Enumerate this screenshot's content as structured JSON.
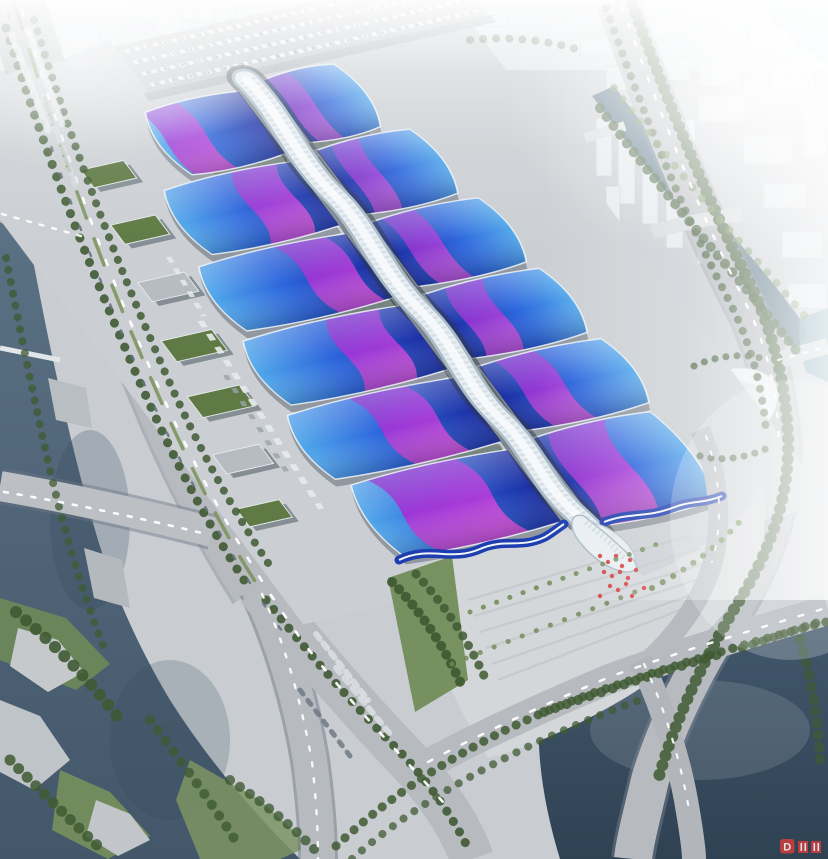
{
  "meta": {
    "alt": "Aerial architectural rendering of a large exhibition and convention center: parallel rows of blue wave-form exhibition halls with magenta ribbon roof graphics, crossed by a white serpentine central concourse ending in a flared entrance canopy at a palm-lined plaza, surrounded by boulevards, canals, rivers, parking lots and a hazy white cityscape."
  },
  "watermark": {
    "letter": "D"
  },
  "palette": {
    "ground": "#c9cdd2",
    "apron": "#cbcfd3",
    "road": "#b7bbc0",
    "road_shadow": "#858d97",
    "hall_deep": "#1b2ea2",
    "hall_blue": "#2b64dc",
    "hall_light": "#4fa6ea",
    "ribbon_purple": "#6a1ec6",
    "ribbon_violet": "#a032d6",
    "ribbon_magenta": "#d44fda",
    "spine_white": "#e9eef2",
    "spine_shade": "#a9bcc8",
    "gutter_dark": "#2c3744",
    "river": "#54697c",
    "canal": "#527083",
    "pond": "#3a4f63",
    "bright_water": "#84bccd",
    "tree_dark": "#3f5a33",
    "tree_light": "#6d8a52",
    "grass": "#567639",
    "plaza": "#d4d7da",
    "haze": "#ffffff",
    "accent_red": "#d23c3c"
  },
  "scene": {
    "halls": [
      {
        "s": "L",
        "o": -120,
        "i": -14,
        "t": 0,
        "b": 78,
        "rc": -92,
        "rw": 40,
        "sw": 16,
        "ro": 0.92
      },
      {
        "s": "R",
        "o": 96,
        "i": 14,
        "t": -6,
        "b": 72,
        "rc": 32,
        "rw": 24,
        "sw": 10,
        "ro": 0.7
      },
      {
        "s": "L",
        "o": -155,
        "i": -14,
        "t": 88,
        "b": 168,
        "rc": -58,
        "rw": 46,
        "sw": -20,
        "ro": 0.9
      },
      {
        "s": "R",
        "o": 120,
        "i": 14,
        "t": 82,
        "b": 162,
        "rc": 42,
        "rw": 28,
        "sw": -12,
        "ro": 0.75
      },
      {
        "s": "L",
        "o": -175,
        "i": -14,
        "t": 178,
        "b": 258,
        "rc": -54,
        "rw": 50,
        "sw": 22,
        "ro": 0.9
      },
      {
        "s": "R",
        "o": 135,
        "i": 14,
        "t": 172,
        "b": 252,
        "rc": 48,
        "rw": 34,
        "sw": 14,
        "ro": 0.8
      },
      {
        "s": "L",
        "o": -185,
        "i": -14,
        "t": 268,
        "b": 348,
        "rc": -68,
        "rw": 54,
        "sw": -22,
        "ro": 0.9
      },
      {
        "s": "R",
        "o": 142,
        "i": 14,
        "t": 262,
        "b": 342,
        "rc": 52,
        "rw": 38,
        "sw": -16,
        "ro": 0.82
      },
      {
        "s": "L",
        "o": -195,
        "i": -14,
        "t": 358,
        "b": 438,
        "rc": -84,
        "rw": 58,
        "sw": 24,
        "ro": 0.92
      },
      {
        "s": "R",
        "o": 150,
        "i": 14,
        "t": 352,
        "b": 432,
        "rc": 58,
        "rw": 42,
        "sw": 18,
        "ro": 0.85
      },
      {
        "s": "L",
        "o": -185,
        "i": -14,
        "t": 448,
        "b": 538,
        "rc": -104,
        "rw": 92,
        "sw": 28,
        "ro": 0.95
      },
      {
        "s": "R",
        "o": 145,
        "i": 14,
        "t": 442,
        "b": 552,
        "rc": 54,
        "rw": 58,
        "sw": -22,
        "ro": 0.9
      }
    ],
    "green_strips": [
      {
        "x": -90,
        "y": 62,
        "w": 72,
        "h": 26
      },
      {
        "x": 18,
        "y": 62,
        "w": 54,
        "h": 26
      },
      {
        "x": -100,
        "y": 248,
        "w": 82,
        "h": 26
      },
      {
        "x": -84,
        "y": 439,
        "w": 64,
        "h": 22
      }
    ],
    "service_buildings": [
      {
        "u": -206,
        "v": 46,
        "w": 44,
        "h": 22,
        "g": 1
      },
      {
        "u": -216,
        "v": 112,
        "w": 46,
        "h": 24,
        "g": 1
      },
      {
        "u": -230,
        "v": 180,
        "w": 48,
        "h": 24,
        "g": 0
      },
      {
        "u": -248,
        "v": 248,
        "w": 52,
        "h": 26,
        "g": 1
      },
      {
        "u": -262,
        "v": 314,
        "w": 54,
        "h": 26,
        "g": 1
      },
      {
        "u": -278,
        "v": 382,
        "w": 48,
        "h": 24,
        "g": 0
      },
      {
        "u": -293,
        "v": 446,
        "w": 44,
        "h": 22,
        "g": 1
      }
    ],
    "city_top_blocks": [
      [
        6,
        6,
        38,
        16
      ],
      [
        50,
        10,
        34,
        14
      ],
      [
        90,
        2,
        42,
        18
      ],
      [
        138,
        8,
        38,
        14
      ],
      [
        182,
        0,
        48,
        20
      ],
      [
        236,
        6,
        42,
        16
      ],
      [
        284,
        10,
        38,
        14
      ],
      [
        328,
        2,
        40,
        18
      ],
      [
        374,
        8,
        42,
        16
      ],
      [
        422,
        4,
        38,
        18
      ],
      [
        464,
        10,
        44,
        16
      ],
      [
        240,
        30,
        60,
        22
      ],
      [
        148,
        28,
        44,
        18
      ],
      [
        60,
        32,
        40,
        16
      ],
      [
        8,
        34,
        36,
        14
      ],
      [
        312,
        34,
        52,
        18
      ],
      [
        380,
        32,
        46,
        16
      ],
      [
        434,
        34,
        40,
        14
      ]
    ],
    "city_domes": [
      [
        168,
        24,
        13
      ],
      [
        206,
        15,
        9
      ],
      [
        232,
        27,
        7
      ]
    ],
    "city_right_blocks": [
      [
        580,
        36,
        46,
        20
      ],
      [
        632,
        18,
        52,
        22
      ],
      [
        690,
        8,
        56,
        24
      ],
      [
        748,
        26,
        50,
        22
      ],
      [
        800,
        16,
        26,
        36
      ],
      [
        606,
        66,
        34,
        24
      ],
      [
        648,
        58,
        42,
        22
      ],
      [
        698,
        96,
        46,
        26
      ],
      [
        744,
        136,
        48,
        28
      ],
      [
        764,
        184,
        42,
        24
      ],
      [
        782,
        232,
        40,
        26
      ],
      [
        700,
        64,
        40,
        22
      ],
      [
        770,
        64,
        44,
        24
      ],
      [
        804,
        110,
        22,
        48
      ],
      [
        788,
        284,
        38,
        24
      ]
    ],
    "city_towers": [
      [
        596,
        118,
        16,
        58
      ],
      [
        618,
        138,
        17,
        66
      ],
      [
        642,
        148,
        16,
        76
      ],
      [
        666,
        168,
        17,
        80
      ],
      [
        697,
        198,
        15,
        66
      ],
      [
        638,
        92,
        13,
        48
      ],
      [
        718,
        228,
        15,
        58
      ],
      [
        742,
        258,
        13,
        50
      ],
      [
        606,
        186,
        14,
        48
      ],
      [
        682,
        120,
        13,
        44
      ]
    ],
    "treelines": [
      {
        "d": "M 6,28 C 36,124 78,240 126,350 C 162,436 200,512 244,580",
        "w": 9,
        "g": 13,
        "o": 0.9,
        "l": 0
      },
      {
        "d": "M 34,20 C 64,118 104,232 152,342 C 188,428 226,500 270,566",
        "w": 8,
        "g": 12,
        "o": 0.85,
        "l": 0
      },
      {
        "d": "M 266,600 C 306,650 352,704 402,754 C 430,784 452,816 468,848",
        "w": 9,
        "g": 12,
        "o": 0.9,
        "l": 0
      },
      {
        "d": "M 392,582 C 420,610 444,646 462,686",
        "w": 10,
        "g": 10,
        "o": 0.92,
        "l": 0
      },
      {
        "d": "M 416,574 C 444,604 468,640 486,680",
        "w": 9,
        "g": 11,
        "o": 0.85,
        "l": 0
      },
      {
        "d": "M 606,8 C 636,92 672,190 726,295 C 748,336 762,382 766,430",
        "w": 8,
        "g": 12,
        "o": 0.8,
        "l": 0
      },
      {
        "d": "M 632,4 C 664,90 700,185 752,288 C 772,330 786,384 788,436 C 790,496 772,548 736,606 C 706,656 676,716 658,780",
        "w": 12,
        "g": 10,
        "o": 0.85,
        "l": 0
      },
      {
        "d": "M 600,108 C 642,164 684,216 732,272 C 756,300 776,326 796,350",
        "w": 10,
        "g": 11,
        "o": 0.8,
        "l": 0
      },
      {
        "d": "M 614,88 C 650,136 690,186 738,240 C 762,266 786,294 808,320",
        "w": 8,
        "g": 14,
        "o": 0.65,
        "l": 1
      },
      {
        "d": "M 336,846 C 420,768 520,716 620,684 C 690,660 760,640 826,622",
        "w": 9,
        "g": 12,
        "o": 0.85,
        "l": 0
      },
      {
        "d": "M 352,859 C 430,790 540,736 640,700",
        "w": 8,
        "g": 13,
        "o": 0.75,
        "l": 0
      },
      {
        "d": "M 652,588 C 690,568 722,544 746,514",
        "w": 6,
        "g": 12,
        "o": 0.9,
        "l": 1
      },
      {
        "d": "M 470,612 C 540,586 610,562 668,540",
        "w": 5,
        "g": 14,
        "o": 0.85,
        "l": 1
      },
      {
        "d": "M 452,664 C 520,636 586,612 640,590",
        "w": 5,
        "g": 15,
        "o": 0.8,
        "l": 1
      },
      {
        "d": "M 544,712 C 600,692 660,672 720,654",
        "w": 10,
        "g": 12,
        "o": 0.85,
        "l": 0
      },
      {
        "d": "M 742,648 C 772,638 800,628 826,620",
        "w": 9,
        "g": 11,
        "o": 0.8,
        "l": 0
      },
      {
        "d": "M 800,640 C 812,680 818,720 820,760",
        "w": 11,
        "g": 12,
        "o": 0.7,
        "l": 0
      },
      {
        "d": "M 16,612 C 50,640 90,680 120,720",
        "w": 12,
        "g": 13,
        "o": 0.9,
        "l": 0
      },
      {
        "d": "M 10,760 C 40,790 70,820 100,848",
        "w": 11,
        "g": 12,
        "o": 0.85,
        "l": 0
      },
      {
        "d": "M 150,720 C 180,760 210,800 235,840",
        "w": 10,
        "g": 13,
        "o": 0.8,
        "l": 0
      },
      {
        "d": "M 230,780 C 260,800 290,824 315,850",
        "w": 10,
        "g": 12,
        "o": 0.8,
        "l": 0
      },
      {
        "d": "M 6,258 C 20,330 34,400 50,470 C 64,530 82,592 104,648",
        "w": 8,
        "g": 12,
        "o": 0.75,
        "l": 0
      },
      {
        "d": "M 470,40 C 510,36 550,40 586,52",
        "w": 8,
        "g": 13,
        "o": 0.5,
        "l": 0
      },
      {
        "d": "M 694,366 C 716,356 744,352 768,360",
        "w": 7,
        "g": 11,
        "o": 0.8,
        "l": 0
      },
      {
        "d": "M 700,456 C 722,462 748,458 772,446",
        "w": 7,
        "g": 11,
        "o": 0.8,
        "l": 0
      }
    ],
    "car_lines": [
      {
        "d": "M 22,10 C 50,105 92,235 144,354 C 186,452 238,552 306,646 C 348,700 402,756 452,812",
        "w": 2.6,
        "da": "5 17",
        "c": "#ffffff",
        "o": 0.95
      },
      {
        "d": "M 8,14 C 38,110 80,238 132,356 C 174,454 226,554 294,648",
        "w": 2.4,
        "da": "4 24",
        "c": "#68727e",
        "o": 0.9
      },
      {
        "d": "M 14,2 C 44,98 86,228 138,348 C 178,444 222,532 262,592",
        "w": 3.5,
        "da": "28 22",
        "c": "#7a9159",
        "o": 0.85
      },
      {
        "d": "M 262,594 C 286,646 302,706 312,762 C 317,806 318,836 318,859",
        "w": 2.4,
        "da": "4 12",
        "c": "#ffffff",
        "o": 0.9
      },
      {
        "d": "M 622,6 C 652,92 690,192 744,300 C 766,342 778,392 779,442",
        "w": 2.4,
        "da": "4 15",
        "c": "#ffffff",
        "o": 0.95
      },
      {
        "d": "M 428,762 C 480,734 545,704 612,676 C 690,648 760,628 826,608",
        "w": 2.4,
        "da": "5 14",
        "c": "#ffffff",
        "o": 0.95
      },
      {
        "d": "M 4,492 C 70,503 140,518 206,534",
        "w": 2.6,
        "da": "4 10",
        "c": "#ffffff",
        "o": 0.95
      },
      {
        "d": "M 644,664 C 664,706 682,764 690,816",
        "w": 2.2,
        "da": "4 12",
        "c": "#ffffff",
        "o": 0.9
      },
      {
        "d": "M 706,436 C 720,476 724,520 712,562",
        "w": 2,
        "da": "4 12",
        "c": "#ffffff",
        "o": 0.85
      },
      {
        "d": "M 2,214 L 88,238",
        "w": 2.4,
        "da": "4 9",
        "c": "#ffffff",
        "o": 0.9
      },
      {
        "d": "M 316,634 L 368,700",
        "w": 6,
        "da": "6 6",
        "c": "#dde1e4",
        "o": 0.85
      },
      {
        "d": "M 336,668 L 390,734",
        "w": 6,
        "da": "6 7",
        "c": "#dde1e4",
        "o": 0.8
      },
      {
        "d": "M 300,690 L 350,756",
        "w": 5,
        "da": "5 8",
        "c": "#6a747f",
        "o": 0.8
      },
      {
        "d": "M 12,36 L 48,130",
        "w": 7,
        "da": "5 5",
        "c": "#e3e7ea",
        "o": 0.8
      },
      {
        "d": "M 28,30 L 62,124",
        "w": 7,
        "da": "5 6",
        "c": "#e3e7ea",
        "o": 0.75
      },
      {
        "d": "M 44,96 L 76,186",
        "w": 6,
        "da": "5 6",
        "c": "#d6dbdf",
        "o": 0.7
      },
      {
        "d": "M 778,360 L 826,347",
        "w": 2.2,
        "da": "4 9",
        "c": "#ffffff",
        "o": 0.85
      }
    ],
    "truck_lines": [
      {
        "d": "M -200,236 L -218,466",
        "w": 6,
        "da": "8 8",
        "c": "#e7eaec",
        "o": 0.9
      },
      {
        "d": "M -186,160 L -194,232",
        "w": 5,
        "da": "7 7",
        "c": "#e7eaec",
        "o": 0.85
      },
      {
        "d": "M -214,300 L -224,420",
        "w": 5,
        "da": "6 10",
        "c": "#9aa2aa",
        "o": 0.8
      }
    ],
    "parking_rows": {
      "u0": -88,
      "u1": 250,
      "vs": [
        -70,
        -56,
        -42,
        -28
      ]
    },
    "plaza_stripes": [
      [
        468,
        600,
        690,
        535
      ],
      [
        474,
        616,
        700,
        549
      ],
      [
        480,
        632,
        706,
        563
      ],
      [
        486,
        648,
        702,
        578
      ],
      [
        492,
        664,
        694,
        594
      ],
      [
        498,
        680,
        680,
        610
      ]
    ],
    "sculpture_dots": [
      [
        600,
        556
      ],
      [
        608,
        562
      ],
      [
        616,
        556
      ],
      [
        622,
        566
      ],
      [
        630,
        560
      ],
      [
        604,
        572
      ],
      [
        612,
        576
      ],
      [
        620,
        572
      ],
      [
        628,
        578
      ],
      [
        636,
        570
      ],
      [
        610,
        586
      ],
      [
        618,
        590
      ],
      [
        626,
        584
      ],
      [
        600,
        596
      ],
      [
        632,
        596
      ],
      [
        644,
        588
      ]
    ],
    "regions": [
      "central-spine-concourse",
      "exhibition-halls",
      "entrance-canopy",
      "entrance-plaza",
      "north-parking-lot",
      "west-service-apron",
      "left-river",
      "right-canal",
      "bottom-right-pond",
      "riverside-park",
      "city-skyline",
      "landmark-building"
    ]
  }
}
